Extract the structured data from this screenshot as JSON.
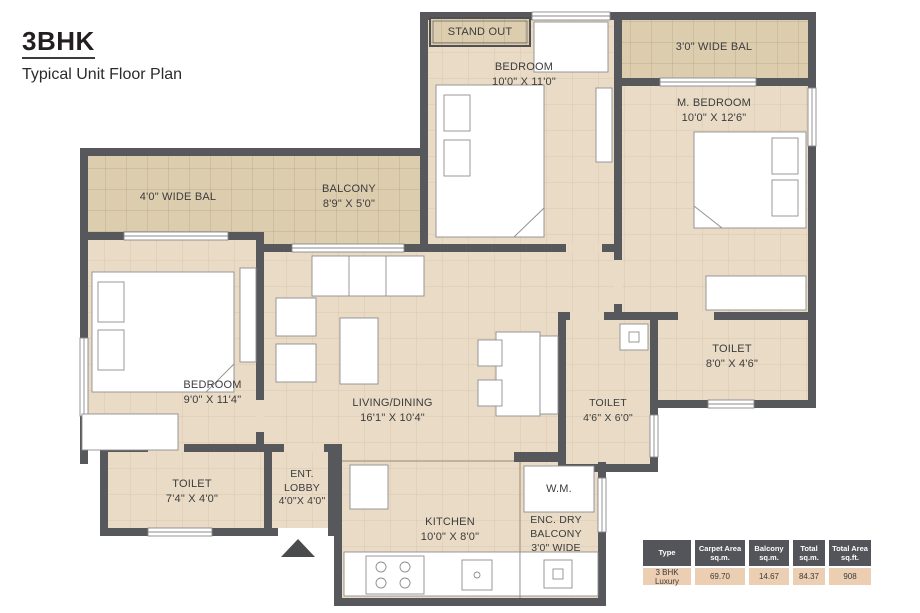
{
  "title": {
    "heading": "3BHK",
    "subheading": "Typical Unit Floor Plan"
  },
  "rooms": {
    "stand_out": "STAND OUT",
    "bedroom_top": "BEDROOM\n10'0\" X 11'0\"",
    "bal_right": "3'0\" WIDE BAL",
    "m_bedroom": "M. BEDROOM\n10'0\" X 12'6\"",
    "bal_left": "4'0\" WIDE BAL",
    "balcony_mid": "BALCONY\n8'9\" X 5'0\"",
    "bedroom_left": "BEDROOM\n9'0\" X 11'4\"",
    "living": "LIVING/DINING\n16'1\" X 10'4\"",
    "toilet_right": "TOILET\n8'0\" X 4'6\"",
    "toilet_mid": "TOILET\n4'6\" X 6'0\"",
    "toilet_left": "TOILET\n7'4\" X 4'0\"",
    "ent_lobby": "ENT.\nLOBBY\n4'0\"X 4'0\"",
    "kitchen": "KITCHEN\n10'0\" X 8'0\"",
    "wm": "W.M.",
    "enc_dry": "ENC. DRY\nBALCONY\n3'0\" WIDE"
  },
  "area_table": {
    "headers": [
      "Type",
      "Carpet Area\nsq.m.",
      "Balcony\nsq.m.",
      "Total\nsq.m.",
      "Total Area\nsq.ft."
    ],
    "row": [
      "3 BHK Luxury",
      "69.70",
      "14.67",
      "84.37",
      "908"
    ]
  },
  "colors": {
    "wall": "#57585b",
    "floor": "#e9dbc6",
    "balcony_floor": "#dccdaf",
    "table_header_bg": "#54555a",
    "table_row_bg": "#eccfb3"
  }
}
